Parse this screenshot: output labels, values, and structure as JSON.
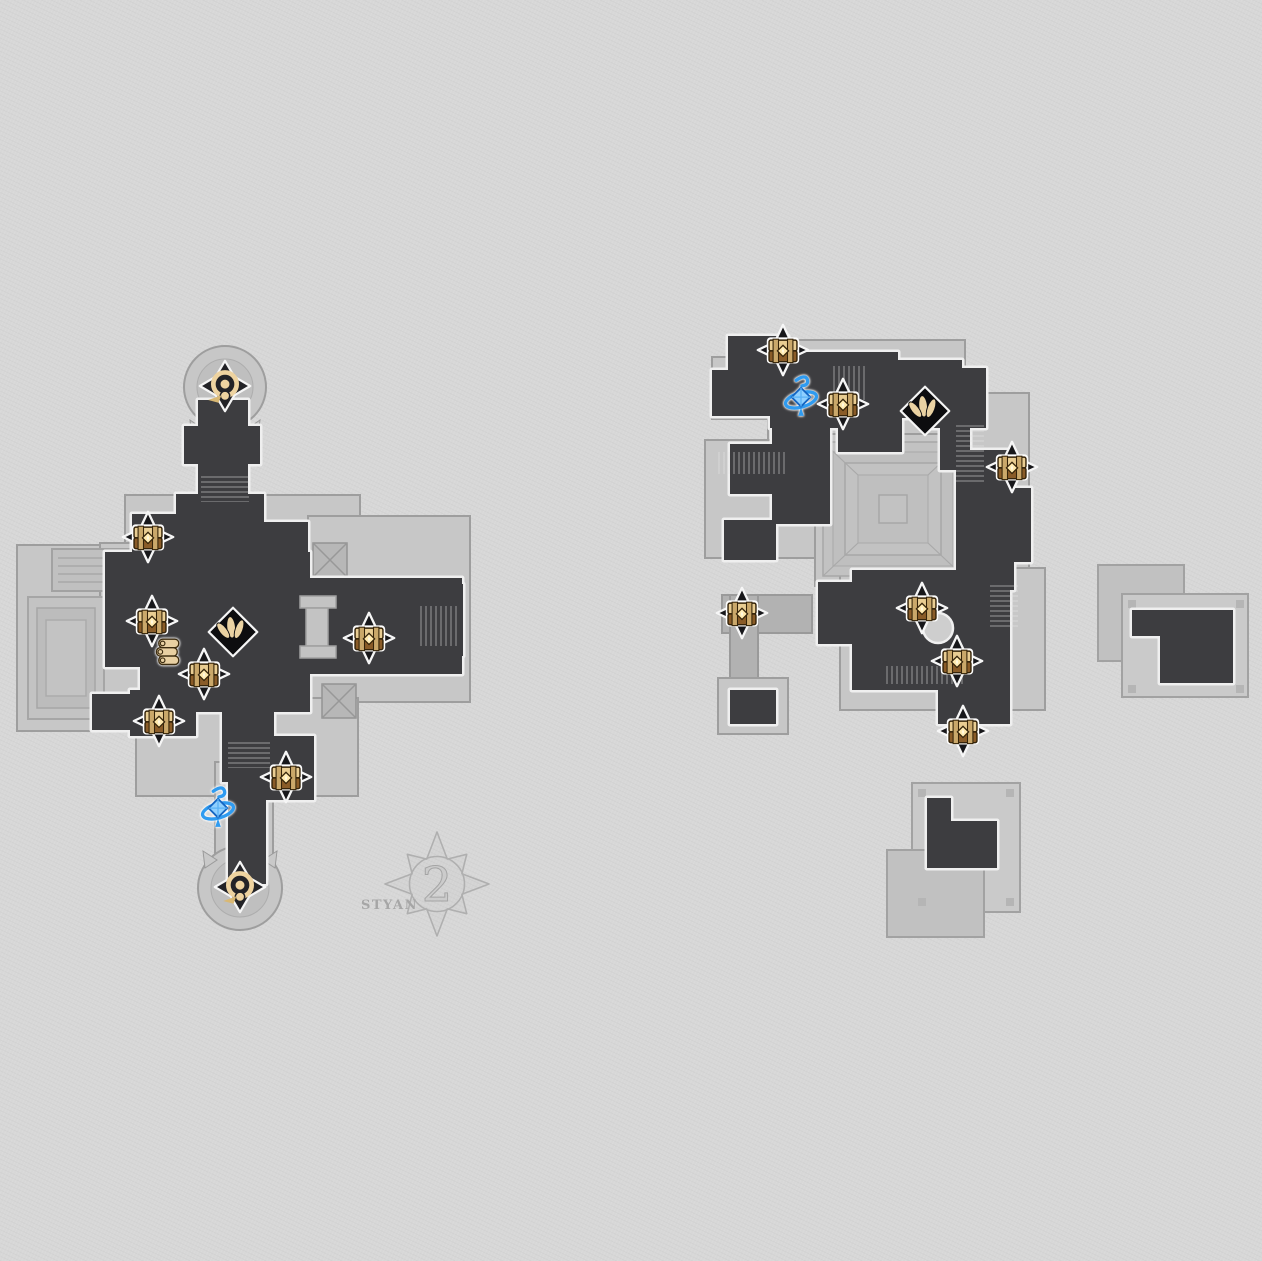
{
  "view": {
    "title": "Game Map Floor View",
    "floor_badge": {
      "number": "2",
      "label": "STYAN"
    }
  },
  "palette": {
    "background": "#d7d7d7",
    "platform_light": "#c7c7c7",
    "platform_mid": "#b2b2b2",
    "room_dark": "#3d3d40",
    "room_outline": "#efefef",
    "platform_outline": "#9e9e9e",
    "chest_tan": "#e9cd92",
    "chest_brown": "#8a5c28",
    "marker_diamond": "#17171a",
    "anchor_tan": "#eed3a0",
    "portal_blue": "#2f9bf0",
    "watermark_gray": "#a6a6a6"
  },
  "markers": [
    {
      "map": "left",
      "type": "teleport",
      "icon": "teleport-anchor-icon",
      "x": 225,
      "y": 386
    },
    {
      "map": "left",
      "type": "chest",
      "icon": "treasure-chest-icon",
      "x": 148,
      "y": 537
    },
    {
      "map": "left",
      "type": "chest",
      "icon": "treasure-chest-icon",
      "x": 152,
      "y": 621
    },
    {
      "map": "left",
      "type": "books",
      "icon": "readable-books-icon",
      "x": 168,
      "y": 653
    },
    {
      "map": "left",
      "type": "chest",
      "icon": "treasure-chest-icon",
      "x": 204,
      "y": 674
    },
    {
      "map": "left",
      "type": "trotter",
      "icon": "warp-trotter-icon",
      "x": 233,
      "y": 632
    },
    {
      "map": "left",
      "type": "chest",
      "icon": "treasure-chest-icon",
      "x": 369,
      "y": 638
    },
    {
      "map": "left",
      "type": "chest",
      "icon": "treasure-chest-icon",
      "x": 159,
      "y": 721
    },
    {
      "map": "left",
      "type": "chest",
      "icon": "treasure-chest-icon",
      "x": 286,
      "y": 777
    },
    {
      "map": "left",
      "type": "gyro",
      "icon": "warp-portal-icon",
      "x": 218,
      "y": 810
    },
    {
      "map": "left",
      "type": "teleport",
      "icon": "teleport-anchor-icon",
      "x": 240,
      "y": 887
    },
    {
      "map": "right",
      "type": "chest",
      "icon": "treasure-chest-icon",
      "x": 783,
      "y": 350
    },
    {
      "map": "right",
      "type": "gyro",
      "icon": "warp-portal-icon",
      "x": 801,
      "y": 399
    },
    {
      "map": "right",
      "type": "chest",
      "icon": "treasure-chest-icon",
      "x": 843,
      "y": 404
    },
    {
      "map": "right",
      "type": "trotter",
      "icon": "warp-trotter-icon",
      "x": 925,
      "y": 411
    },
    {
      "map": "right",
      "type": "chest",
      "icon": "treasure-chest-icon",
      "x": 1012,
      "y": 467
    },
    {
      "map": "right",
      "type": "chest",
      "icon": "treasure-chest-icon",
      "x": 742,
      "y": 613
    },
    {
      "map": "right",
      "type": "chest",
      "icon": "treasure-chest-icon",
      "x": 922,
      "y": 608
    },
    {
      "map": "right",
      "type": "chest",
      "icon": "treasure-chest-icon",
      "x": 957,
      "y": 661
    },
    {
      "map": "right",
      "type": "chest",
      "icon": "treasure-chest-icon",
      "x": 963,
      "y": 731
    }
  ]
}
